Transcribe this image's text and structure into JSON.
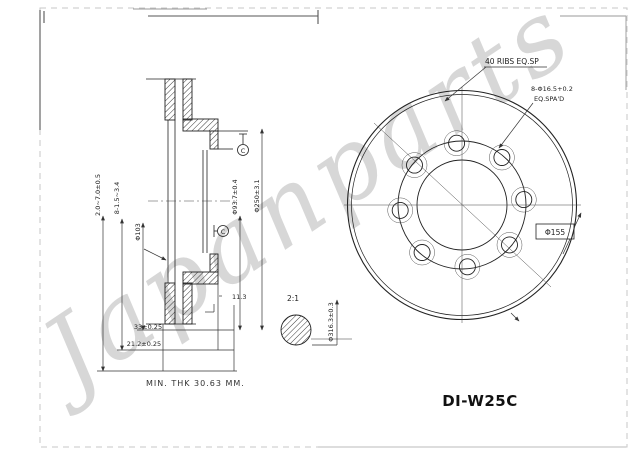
{
  "watermark": {
    "text": "Japanparts"
  },
  "part_number": "DI-W25C",
  "section_view": {
    "dim_labels": {
      "d1": "2.0~7.0±0.5",
      "d2": "8-1.5~3.4",
      "d3": "Φ103",
      "d4": "Φ93.7±0.4",
      "d5": "Φ250±3.1"
    },
    "bottom_dims": {
      "width": "33±0.25",
      "inner_width": "21.2±0.25"
    },
    "step_dim": "11.3",
    "min_thickness_note": "MIN. THK 30.63 MM.",
    "datum_label": "C"
  },
  "front_view": {
    "ribs_note": "40 RIBS EQ.SP",
    "holes_note_line1": "8-Φ16.5+0.2",
    "holes_note_line2": "EQ.SPA'D",
    "bore_dim": "Φ155",
    "outer_dia": "Φ316.3±0.3",
    "detail_scale": "2:1"
  }
}
